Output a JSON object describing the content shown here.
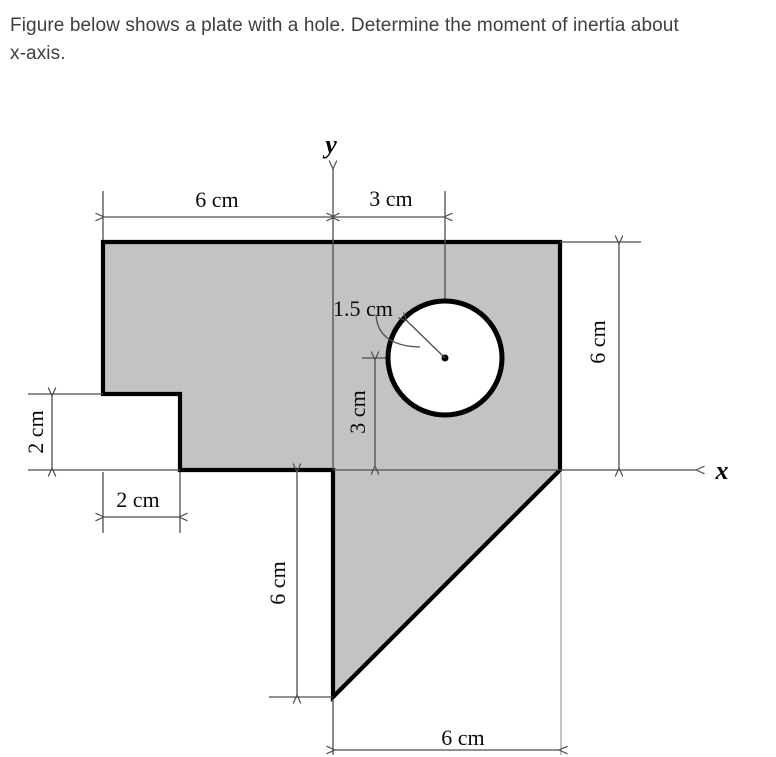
{
  "title_lines": [
    "Figure below shows a plate with a hole. Determine the moment of inertia about",
    "x-axis."
  ],
  "figure": {
    "axis_labels": {
      "x": "x",
      "y": "y"
    },
    "dimensions": {
      "top_left_width": "6 cm",
      "top_right_width": "3 cm",
      "hole_radius": "1.5 cm",
      "right_height": "6 cm",
      "hole_center_height": "3 cm",
      "notch_height": "2 cm",
      "notch_width": "2 cm",
      "triangle_height": "6 cm",
      "triangle_base": "6 cm"
    },
    "colors": {
      "plate_fill": "#c3c3c3",
      "hole_fill": "#ffffff",
      "outline": "#000000",
      "dimension_line": "#4d4d4d"
    }
  }
}
